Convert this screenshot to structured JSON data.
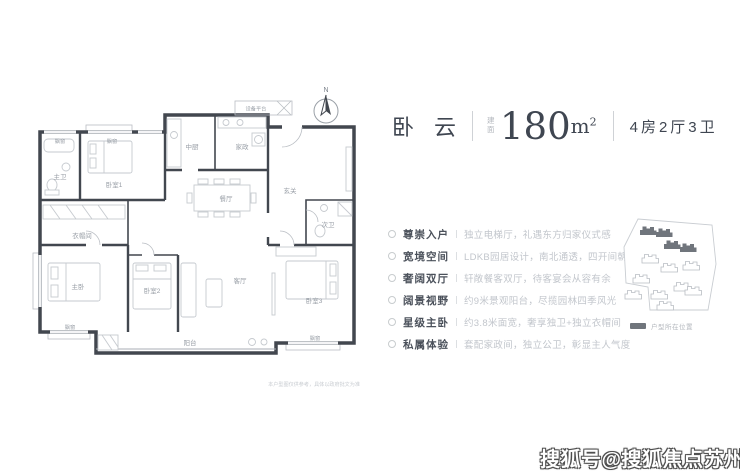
{
  "header": {
    "title": "卧云",
    "area_label": "建面",
    "area_value": "180",
    "area_unit": "m",
    "area_sup": "2",
    "spec": "4房2厅3卫"
  },
  "features": [
    {
      "label": "尊崇入户",
      "desc": "独立电梯厅，礼遇东方归家仪式感"
    },
    {
      "label": "宽境空间",
      "desc": "LDKB园居设计，南北通透，四开间朝南"
    },
    {
      "label": "奢阔双厅",
      "desc": "轩敞餐客双厅，待客宴会从容有余"
    },
    {
      "label": "阔景视野",
      "desc": "约9米景观阳台，尽揽园林四季风光"
    },
    {
      "label": "星级主卧",
      "desc": "约3.8米面宽，奢享独卫+独立衣帽间"
    },
    {
      "label": "私属体验",
      "desc": "套配家政间，独立公卫，彰显主人气度"
    }
  ],
  "floor_plan": {
    "rooms": {
      "bay_window": "飘窗",
      "master_bath": "主卫",
      "bedroom1": "卧室1",
      "closet": "衣帽间",
      "master_bedroom": "主卧",
      "kitchen_mid": "中厨",
      "laundry": "家政",
      "dining": "餐厅",
      "foyer": "玄关",
      "living": "客厅",
      "bedroom2": "卧室2",
      "bath2": "次卫",
      "bedroom3": "卧室3",
      "balcony": "阳台",
      "equipment": "设备平台"
    },
    "disclaimer": "本户型图仅供参考，具体以政府批文为准"
  },
  "compass": {
    "label": "N"
  },
  "site_map": {
    "legend": "户型所在位置"
  },
  "watermark": {
    "text": "搜狐号@搜狐焦点苏州站"
  },
  "colors": {
    "ink": "#42474f",
    "muted": "#c2c6cc",
    "building_highlight": "#70757c"
  }
}
